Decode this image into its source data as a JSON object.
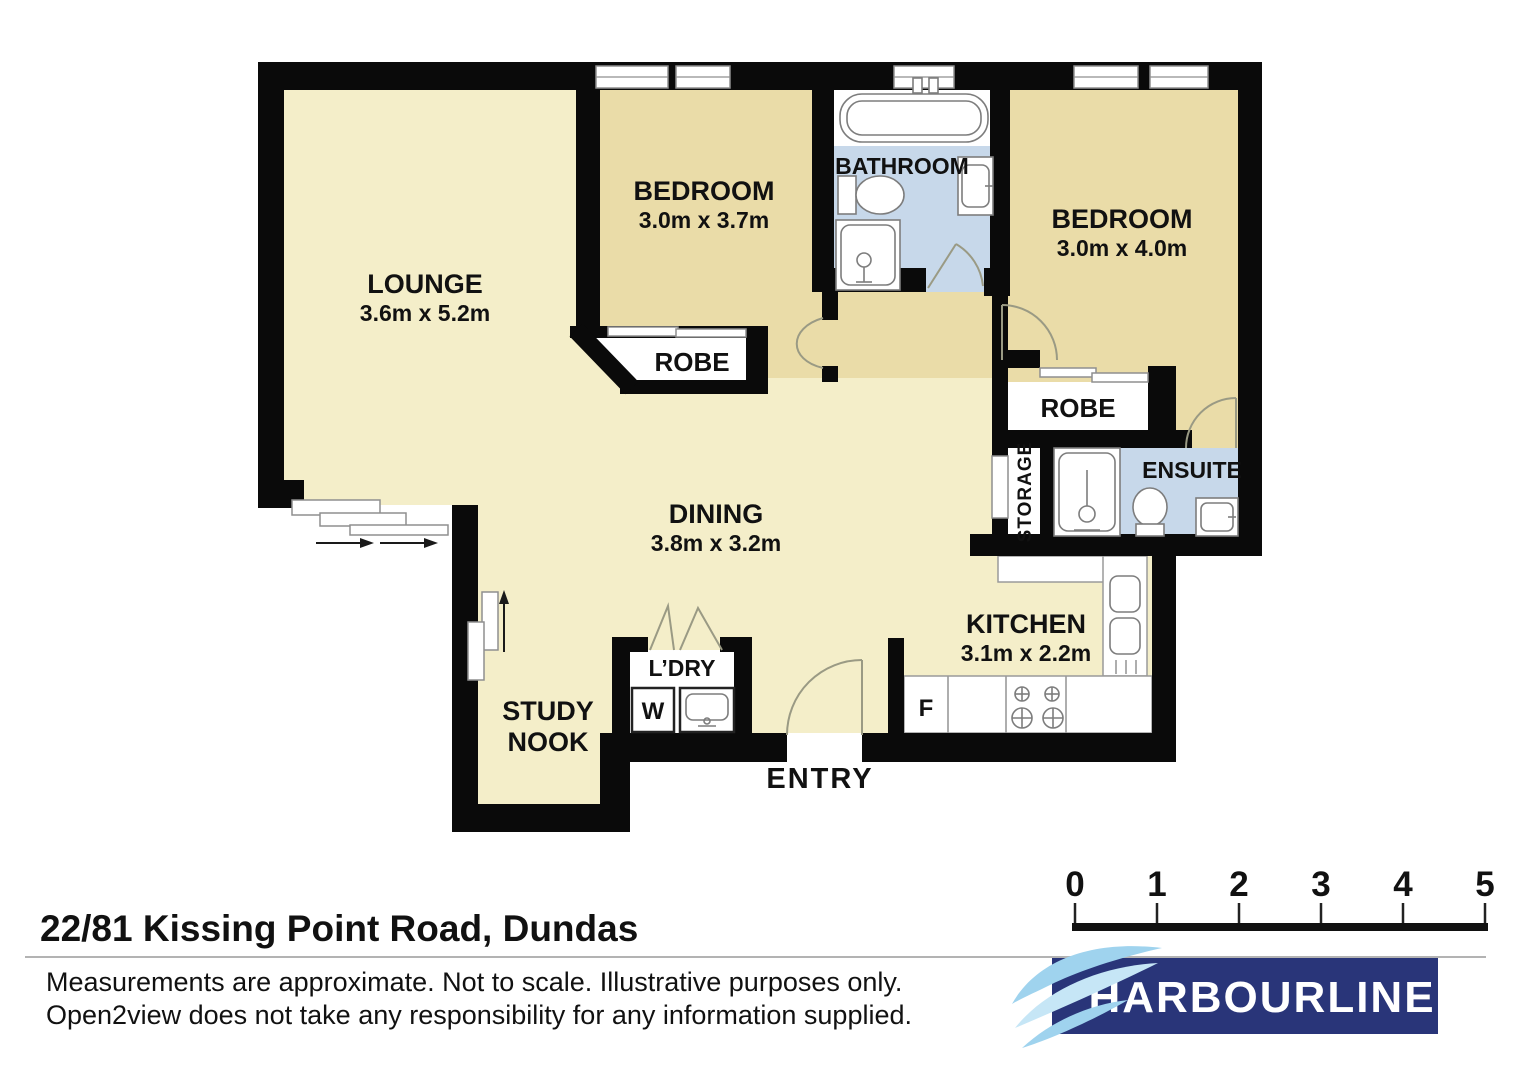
{
  "colors": {
    "floor_living": "#f4eec9",
    "floor_bedroom": "#eadca8",
    "floor_wet": "#c7d8ea",
    "wall": "#0a0a0a",
    "logo_navy": "#293579",
    "wave_blue": "#9fd3ee",
    "wave_pale": "#c6e6f6"
  },
  "rooms": {
    "lounge": {
      "name": "LOUNGE",
      "dims": "3.6m x 5.2m"
    },
    "bedroom1": {
      "name": "BEDROOM",
      "dims": "3.0m x 3.7m"
    },
    "bedroom2": {
      "name": "BEDROOM",
      "dims": "3.0m x 4.0m"
    },
    "dining": {
      "name": "DINING",
      "dims": "3.8m x 3.2m"
    },
    "kitchen": {
      "name": "KITCHEN",
      "dims": "3.1m x 2.2m"
    },
    "bathroom": {
      "name": "BATHROOM"
    },
    "ensuite": {
      "name": "ENSUITE"
    },
    "storage": {
      "name": "STORAGE"
    },
    "robe_bed1": {
      "name": "ROBE"
    },
    "robe_bed2": {
      "name": "ROBE"
    },
    "laundry": {
      "name": "L’DRY"
    },
    "study_nook": {
      "line1": "STUDY",
      "line2": "NOOK"
    },
    "entry": {
      "name": "ENTRY"
    }
  },
  "appliances": {
    "fridge": "F",
    "washer": "W"
  },
  "scale_bar": {
    "ticks": [
      "0",
      "1",
      "2",
      "3",
      "4",
      "5"
    ]
  },
  "footer": {
    "address": "22/81 Kissing Point Road, Dundas",
    "disclaimer_line1": "Measurements are approximate. Not to scale. Illustrative purposes only.",
    "disclaimer_line2": "Open2view does not take any responsibility for any information supplied."
  },
  "brand": {
    "name": "HARBOURLINE"
  }
}
